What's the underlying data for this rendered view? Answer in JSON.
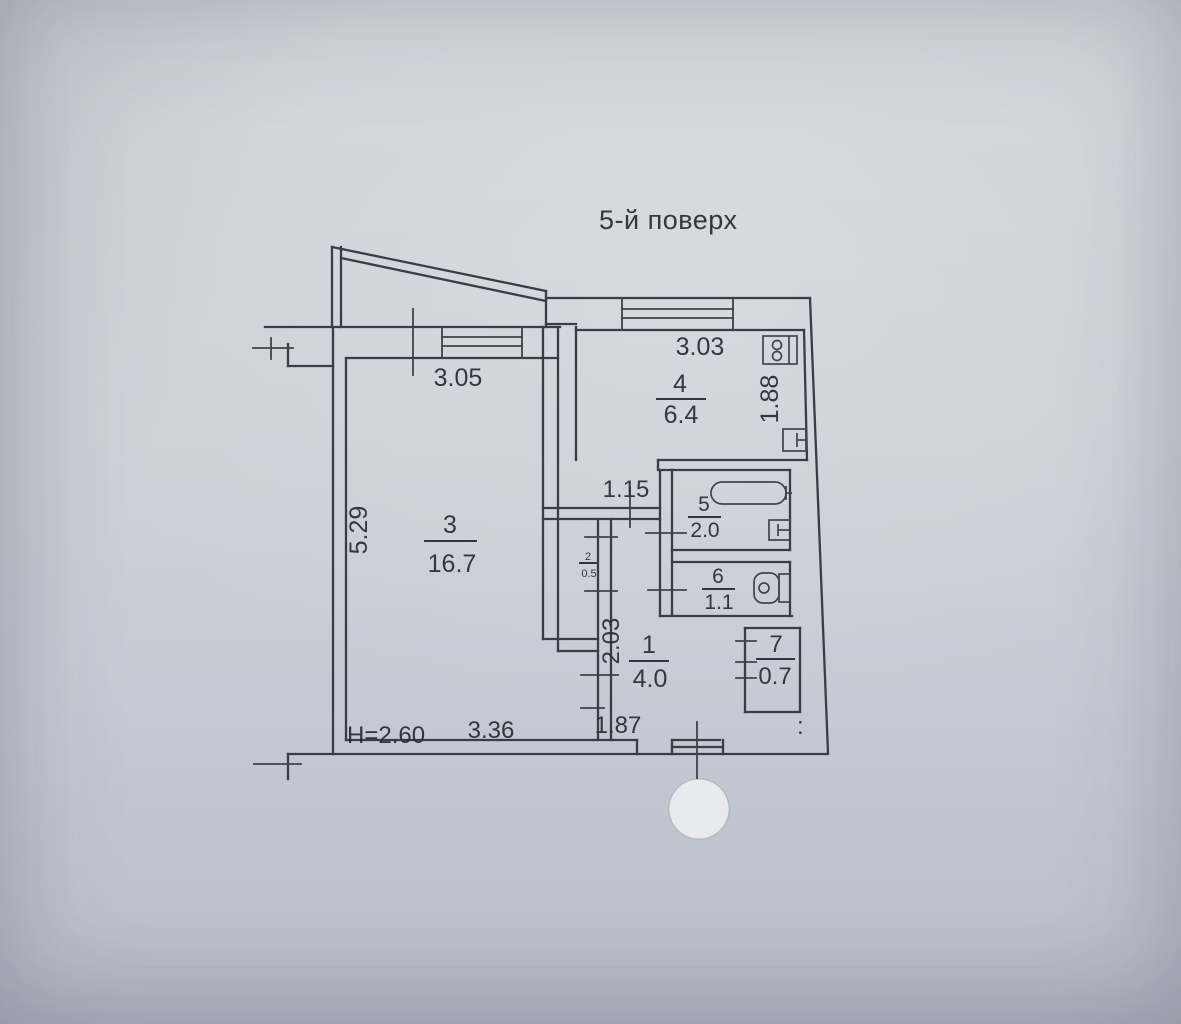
{
  "photo": {
    "title": "5-й поверх",
    "stamp_mark": ":",
    "colors": {
      "paper": "#cdd1d8",
      "ink": "#2f323a"
    }
  },
  "rooms": {
    "r1": {
      "number": "1",
      "area": "4.0"
    },
    "r2": {
      "number": "2",
      "area": "0.5"
    },
    "r3": {
      "number": "3",
      "area": "16.7"
    },
    "r4": {
      "number": "4",
      "area": "6.4"
    },
    "r5": {
      "number": "5",
      "area": "2.0"
    },
    "r6": {
      "number": "6",
      "area": "1.1"
    },
    "r7": {
      "number": "7",
      "area": "0.7"
    }
  },
  "dimensions": {
    "room3_width": "3.05",
    "room3_depth": "5.29",
    "room3_bottom": "3.36",
    "kitchen_width": "3.03",
    "kitchen_depth": "1.88",
    "passage": "1.15",
    "hall_depth": "2.03",
    "entry": "1.87",
    "ceiling_height": "H=2.60"
  },
  "icons": [
    "stove-icon",
    "bathtub-icon",
    "sink-icon",
    "toilet-icon",
    "stamp-circle"
  ]
}
